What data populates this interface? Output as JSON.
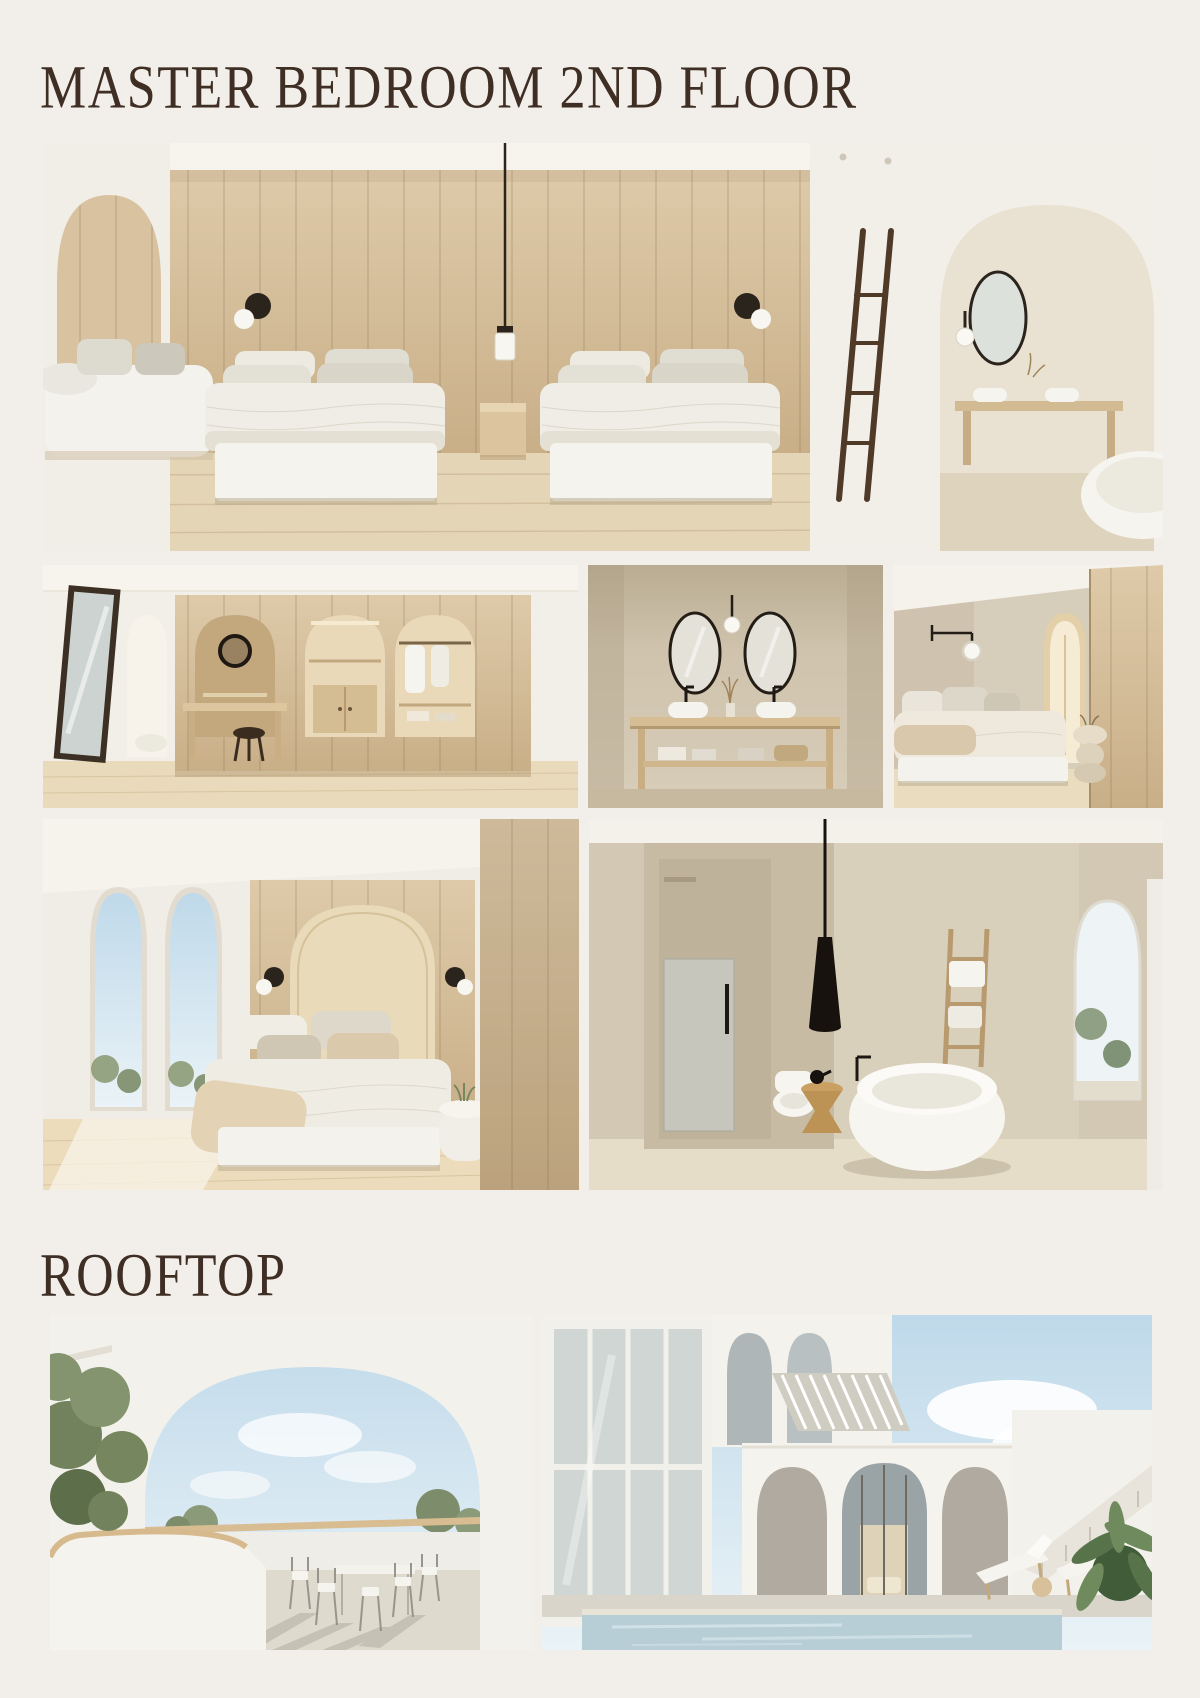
{
  "page": {
    "background_color": "#f2eeea",
    "heading_color": "#3e2e23"
  },
  "sections": {
    "master_bedroom": {
      "title": "MASTER BEDROOM 2ND FLOOR"
    },
    "rooftop": {
      "title": "ROOFTOP"
    }
  },
  "images": {
    "hero_twin_bedroom": {
      "label": "Render: master bedroom with two beds against a wood panel wall, pendant lamp, black wall sconces, arched sofa nook at left and large arched opening to a bathroom vanity and tub at right"
    },
    "dressing_room": {
      "label": "Render: dressing area with three arched wood wardrobe niches, round black vanity mirror, stool, and a dark leaning floor mirror beside an arched doorway"
    },
    "vanity_bathroom": {
      "label": "Render: beige bathroom vanity with two black-framed oval mirrors, wall lamp, twin white basins and a wooden console with towels"
    },
    "bedroom_corner": {
      "label": "Render: bedroom corner with black swing-arm sconce, low bed with beige bedding, sculptural side table and wood slat wall"
    },
    "bedroom_arched_windows": {
      "label": "Render: bedroom with two tall arched windows, arched wood headboard niche, layered pillows and throw, curved white nightstand"
    },
    "bathroom_tub": {
      "label": "Render: bathroom with glass shower, toilet niche, round freestanding tub, black cone pendant lamp, wooden ladder and stool, arched garden window"
    },
    "rooftop_terrace": {
      "label": "Render: rooftop terrace seen through a large white arch, metal outdoor dining set with long shadows, curved white parapet planter and green trees"
    },
    "rooftop_pool": {
      "label": "Render: white arched villa exterior with glazed facade, pergola slat roof, staircase, two sun loungers, tropical plant and a rooftop pool"
    }
  },
  "colors": {
    "wood": "#d5bf9c",
    "sky": "#c9dfee",
    "pool_water": "#b7ced6",
    "greenery": "#76865f",
    "accent_dark": "#2b241d"
  }
}
